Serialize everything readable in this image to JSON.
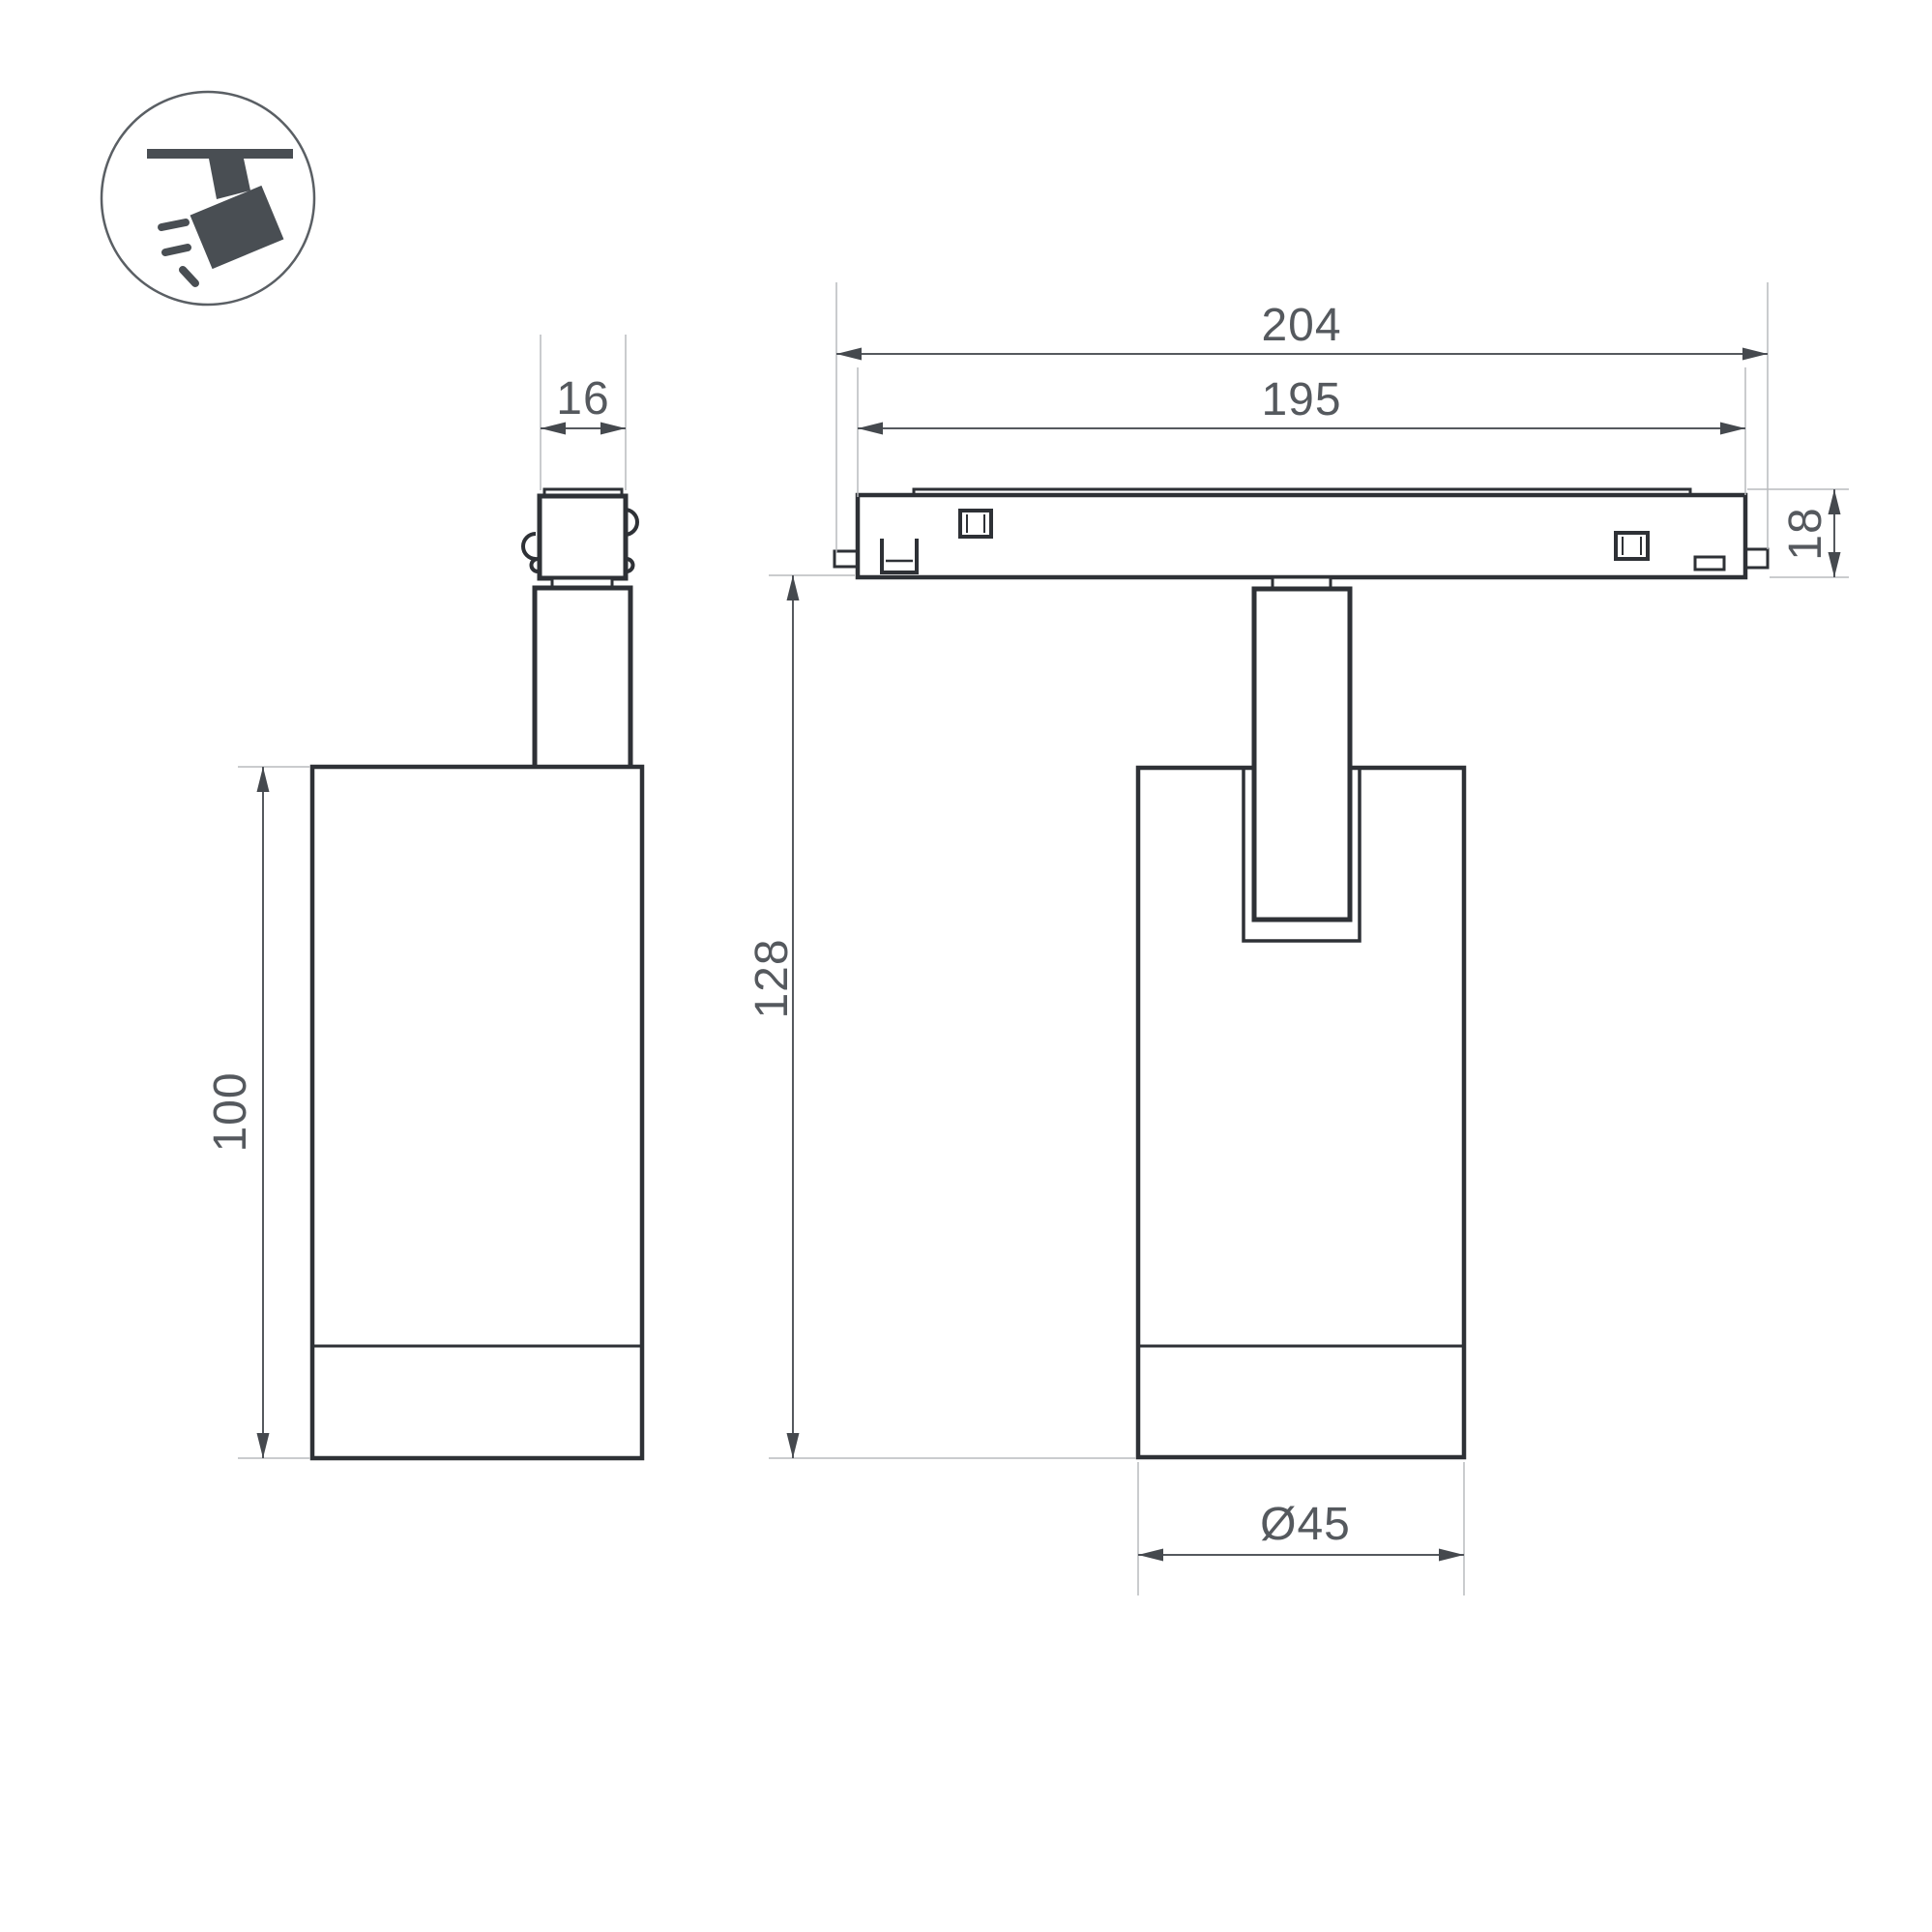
{
  "icon": {
    "name": "track-spotlight-pictogram",
    "color": "#494e53"
  },
  "dimensions": {
    "adapter_width": "16",
    "track_total_length": "204",
    "track_inner_length": "195",
    "track_height": "18",
    "body_height": "100",
    "total_height": "128",
    "body_diameter": "Ø45"
  },
  "colors": {
    "object_line": "#2e3136",
    "dimension_line": "#55595e",
    "arrow_fill": "#45494e",
    "extension_line": "#b9bbbd",
    "background": "#ffffff"
  }
}
